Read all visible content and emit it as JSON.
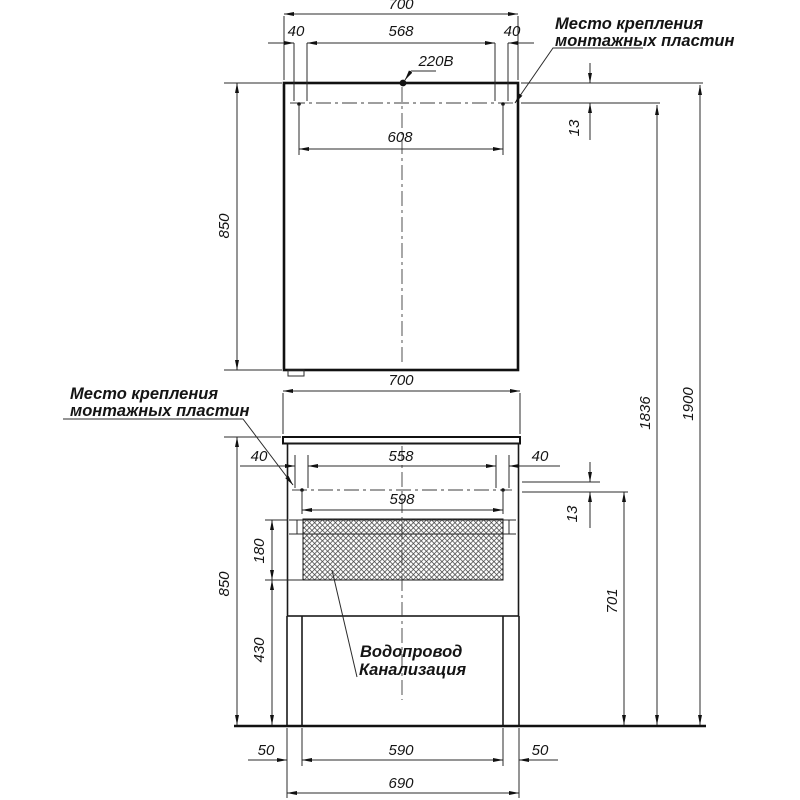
{
  "labels": {
    "mounting_plates_top": [
      "Место крепления",
      "монтажных пластин"
    ],
    "mounting_plates_left": [
      "Место крепления",
      "монтажных пластин"
    ],
    "power": "220В",
    "plumbing": [
      "Водопровод",
      "Канализация"
    ]
  },
  "dims_mirror": {
    "width": "700",
    "plate_left": "40",
    "plate_span": "568",
    "plate_right": "40",
    "plate_outer": "608",
    "plate_depth": "13",
    "height": "850"
  },
  "dims_overall": {
    "to_plates": "1836",
    "total": "1900"
  },
  "dims_vanity": {
    "width": "700",
    "plate_left": "40",
    "plate_span": "558",
    "plate_right": "40",
    "plate_outer": "598",
    "plate_depth": "13",
    "opening_height": "180",
    "height": "850",
    "below_opening": "430",
    "plate_to_floor": "701",
    "leg_left": "50",
    "leg_span": "590",
    "leg_right": "50",
    "base_width": "690"
  },
  "colors": {
    "line": "#1a1a1a",
    "background": "#ffffff"
  }
}
